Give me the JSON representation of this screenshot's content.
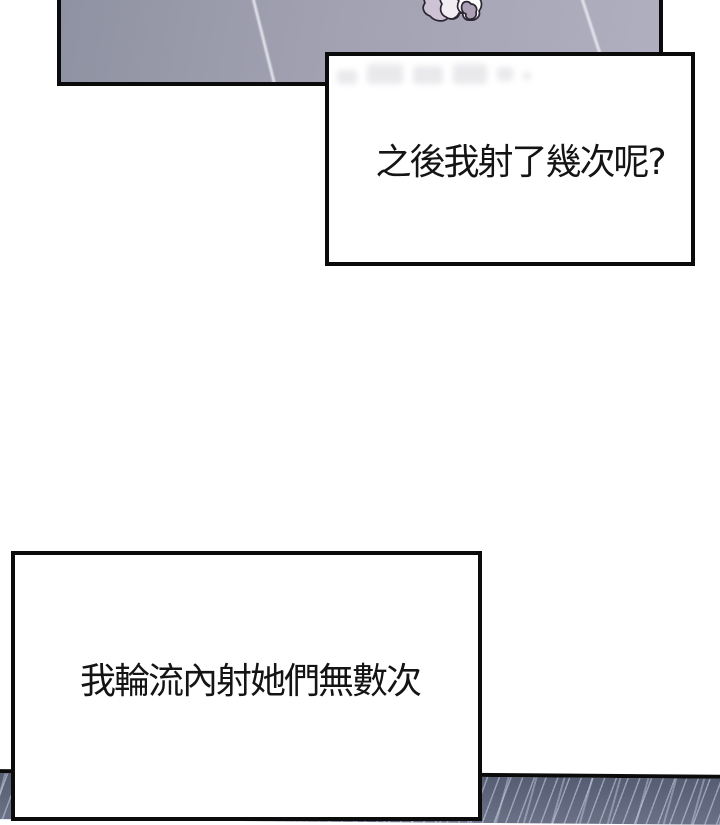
{
  "page": {
    "type": "comic-page",
    "background_color": "#ffffff",
    "ink_color": "#0b0b0b"
  },
  "dialogue": {
    "bubble1": {
      "text": "之後我射了幾次呢?"
    },
    "bubble2": {
      "text": "我輪流內射她們無數次"
    }
  },
  "artwork": {
    "floor_panel": {
      "description": "overhead view of a gray-lavender tiled floor with light diagonal grout lines",
      "base_color_left": "#8f92a2",
      "base_color_right": "#b0afbf",
      "grout_line_color": "#e9ebf3",
      "object": "crumpled-tissue"
    },
    "bubble1_watermark": "faint blurred smudges of erased original lettering",
    "bottom_panel": {
      "description": "sliver of next panel showing blue-gray fabric with diagonal weave streaks",
      "base_color": "#616880",
      "streak_color": "#cad0e4"
    }
  }
}
